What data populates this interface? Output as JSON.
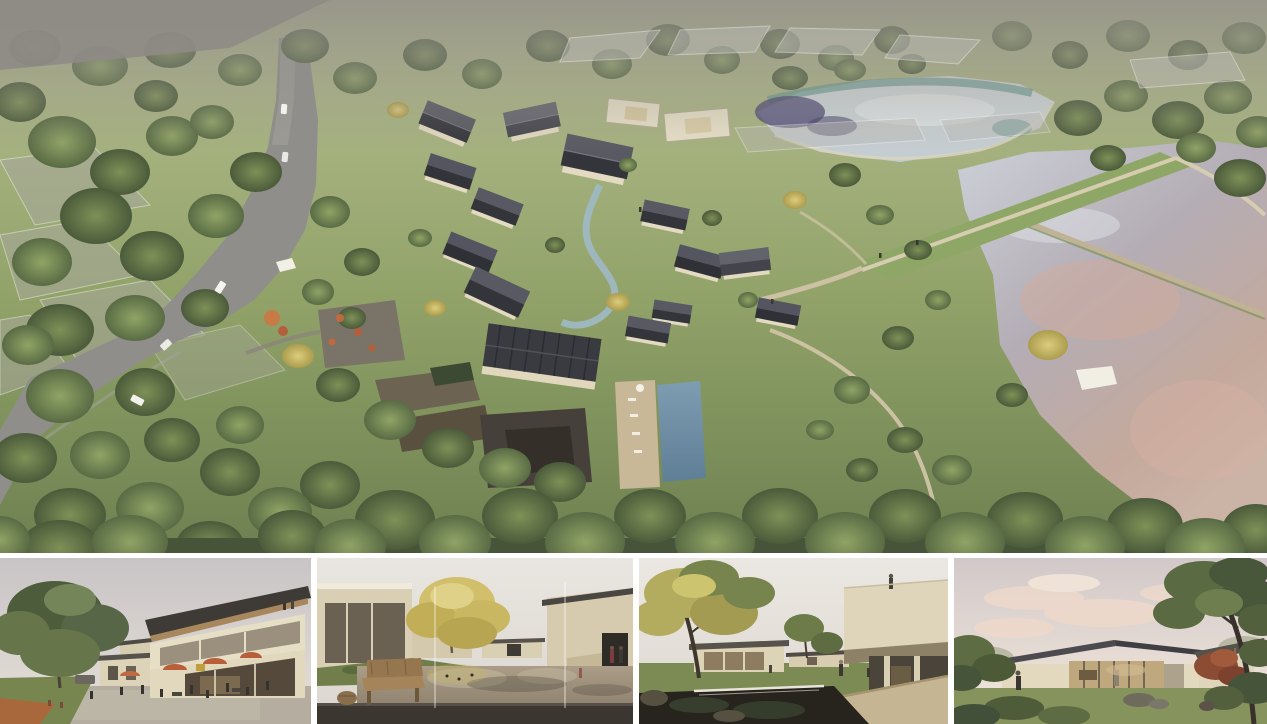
{
  "page": {
    "title": "architecture-rendering-presentation-board",
    "background": "#ffffff"
  },
  "panels": {
    "aerial": {
      "name": "aerial-masterplan-rendering"
    },
    "thumbnails": [
      {
        "name": "thumbnail-plaza-cafe-view"
      },
      {
        "name": "thumbnail-reflecting-pond-courtyard-view"
      },
      {
        "name": "thumbnail-garden-pond-waterfall-view"
      },
      {
        "name": "thumbnail-lakeside-pavilion-view"
      }
    ]
  },
  "palette": {
    "page_bg": "#ffffff",
    "grass_light": "#b8bf92",
    "grass": "#95a56c",
    "grass_dark": "#6f8150",
    "tree_dark": "#4c5c3c",
    "tree_mid": "#687a4c",
    "tree_gold": "#c8b866",
    "road_gray": "#908f8b",
    "roof_dark": "#36373c",
    "roof_light": "#55565e",
    "wall_cream": "#e3dac1",
    "water_pond": "#ccd4d7",
    "water_teal": "#5d958c",
    "water_lake": "#b6afb7",
    "water_pink": "#d6b0a0",
    "pool_blue": "#6e8da4",
    "stream_blue": "#9fb9c5",
    "stone_dark": "#46403a",
    "path_tan": "#ccc2a3",
    "haze_gray": "#908d87",
    "sky_thumb": "#ddd5d2",
    "cloud_pink": "#eed9ca",
    "deck_dark": "#3a352f",
    "pond_tan": "#a3957f",
    "pond_dark": "#26221d",
    "umbrella_orange": "#bc6740",
    "wood_warm": "#a5855c"
  }
}
